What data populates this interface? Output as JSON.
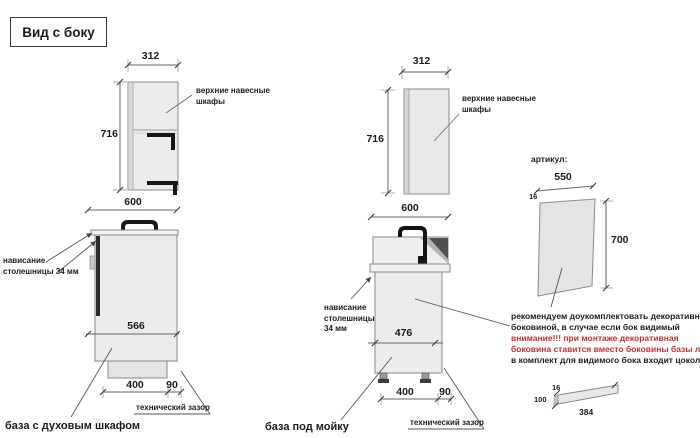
{
  "title": "Вид с боку",
  "wall_cabinet_left": {
    "width": "312",
    "height": "716",
    "label": "верхние навесные шкафы"
  },
  "base_oven": {
    "width": "600",
    "depth": "566",
    "floor": "400",
    "gap": "90",
    "overhang_note": "нависание столешницы 34 мм",
    "gap_note": "технический зазор",
    "caption": "база с духовым шкафом"
  },
  "wall_cabinet_mid": {
    "width": "312",
    "height": "716",
    "label": "верхние навесные шкафы"
  },
  "base_sink": {
    "width": "600",
    "depth": "476",
    "floor": "400",
    "gap": "90",
    "overhang_note": "нависание столешницы 34 мм",
    "gap_note": "технический зазор",
    "caption": "база под мойку"
  },
  "decor_panel": {
    "article_label": "артикул:",
    "width": "550",
    "thickness": "16",
    "height": "700"
  },
  "note": {
    "line1": "рекомендуем доукомплектовать декоративной",
    "line2": "боковиной, в случае если бок видимый",
    "line3": "внимание!!! при монтаже декоративная",
    "line4": "боковина ставится вместо боковины базы лдсп",
    "line5": "в комплект для видимого бока входит цоколь:"
  },
  "plinth": {
    "thickness": "16",
    "height": "100",
    "length": "384"
  },
  "colors": {
    "warning_red": "#c23030",
    "cabinet_fill": "#ececec",
    "line_color": "#666666"
  }
}
